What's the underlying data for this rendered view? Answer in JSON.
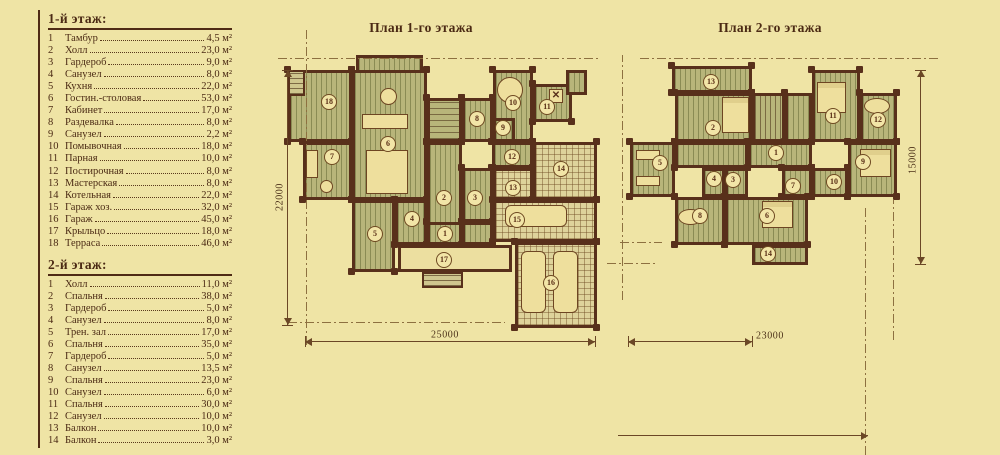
{
  "legend": {
    "sections": [
      {
        "title": "1-й этаж:",
        "rows": [
          [
            "1",
            "Тамбур",
            "4,5 м²"
          ],
          [
            "2",
            "Холл",
            "23,0 м²"
          ],
          [
            "3",
            "Гардероб",
            "9,0 м²"
          ],
          [
            "4",
            "Санузел",
            "8,0 м²"
          ],
          [
            "5",
            "Кухня",
            "22,0 м²"
          ],
          [
            "6",
            "Гостин.-столовая",
            "53,0 м²"
          ],
          [
            "7",
            "Кабинет",
            "17,0 м²"
          ],
          [
            "8",
            "Раздевалка",
            "8,0 м²"
          ],
          [
            "9",
            "Санузел",
            "2,2 м²"
          ],
          [
            "10",
            "Помывочная",
            "18,0 м²"
          ],
          [
            "11",
            "Парная",
            "10,0 м²"
          ],
          [
            "12",
            "Постирочная",
            "8,0 м²"
          ],
          [
            "13",
            "Мастерская",
            "8,0 м²"
          ],
          [
            "14",
            "Котельная",
            "22,0 м²"
          ],
          [
            "15",
            "Гараж хоз.",
            "32,0 м²"
          ],
          [
            "16",
            "Гараж",
            "45,0 м²"
          ],
          [
            "17",
            "Крыльцо",
            "18,0 м²"
          ],
          [
            "18",
            "Терраса",
            "46,0 м²"
          ]
        ]
      },
      {
        "title": "2-й этаж:",
        "rows": [
          [
            "1",
            "Холл",
            "11,0 м²"
          ],
          [
            "2",
            "Спальня",
            "38,0 м²"
          ],
          [
            "3",
            "Гардероб",
            "5,0 м²"
          ],
          [
            "4",
            "Санузел",
            "8,0 м²"
          ],
          [
            "5",
            "Трен. зал",
            "17,0 м²"
          ],
          [
            "6",
            "Спальня",
            "35,0 м²"
          ],
          [
            "7",
            "Гардероб",
            "5,0 м²"
          ],
          [
            "8",
            "Санузел",
            "13,5 м²"
          ],
          [
            "9",
            "Спальня",
            "23,0 м²"
          ],
          [
            "10",
            "Санузел",
            "6,0 м²"
          ],
          [
            "11",
            "Спальня",
            "30,0 м²"
          ],
          [
            "12",
            "Санузел",
            "10,0 м²"
          ],
          [
            "13",
            "Балкон",
            "10,0 м²"
          ],
          [
            "14",
            "Балкон",
            "3,0 м²"
          ]
        ]
      }
    ]
  },
  "plans": [
    {
      "title": "План 1-го этажа",
      "title_left": 321,
      "rooms": [
        {
          "x": 288,
          "y": 70,
          "w": 64,
          "h": 72,
          "f": "plank",
          "n": "18",
          "lx": 329,
          "ly": 102
        },
        {
          "x": 288,
          "y": 70,
          "w": 17,
          "h": 26,
          "f": "steps"
        },
        {
          "x": 303,
          "y": 142,
          "w": 49,
          "h": 58,
          "f": "plank",
          "n": "7",
          "lx": 332,
          "ly": 157
        },
        {
          "x": 356,
          "y": 55,
          "w": 67,
          "h": 18,
          "f": "plank"
        },
        {
          "x": 352,
          "y": 70,
          "w": 75,
          "h": 130,
          "f": "plank",
          "n": "6",
          "lx": 388,
          "ly": 144
        },
        {
          "x": 427,
          "y": 98,
          "w": 35,
          "h": 44,
          "f": "stairs-h"
        },
        {
          "x": 462,
          "y": 98,
          "w": 31,
          "h": 44,
          "f": "plank",
          "n": "8",
          "lx": 477,
          "ly": 119
        },
        {
          "x": 493,
          "y": 70,
          "w": 40,
          "h": 72,
          "f": "plank",
          "n": "10",
          "lx": 513,
          "ly": 103
        },
        {
          "x": 493,
          "y": 118,
          "w": 22,
          "h": 24,
          "f": "plank",
          "n": "9",
          "lx": 503,
          "ly": 128
        },
        {
          "x": 533,
          "y": 84,
          "w": 39,
          "h": 38,
          "f": "plank",
          "n": "11",
          "lx": 547,
          "ly": 107
        },
        {
          "x": 566,
          "y": 70,
          "w": 21,
          "h": 25,
          "f": "plank"
        },
        {
          "x": 492,
          "y": 142,
          "w": 41,
          "h": 26,
          "f": "plank",
          "n": "12",
          "lx": 512,
          "ly": 157
        },
        {
          "x": 533,
          "y": 142,
          "w": 64,
          "h": 58,
          "f": "grid",
          "n": "14",
          "lx": 561,
          "ly": 169
        },
        {
          "x": 493,
          "y": 168,
          "w": 40,
          "h": 32,
          "f": "grid",
          "n": "13",
          "lx": 513,
          "ly": 188
        },
        {
          "x": 427,
          "y": 142,
          "w": 35,
          "h": 103,
          "f": "plank",
          "n": "2",
          "lx": 444,
          "ly": 198
        },
        {
          "x": 462,
          "y": 168,
          "w": 31,
          "h": 54,
          "f": "plank",
          "n": "3",
          "lx": 475,
          "ly": 198
        },
        {
          "x": 462,
          "y": 222,
          "w": 31,
          "h": 23,
          "f": "plank"
        },
        {
          "x": 352,
          "y": 200,
          "w": 43,
          "h": 72,
          "f": "plank",
          "n": "5",
          "lx": 375,
          "ly": 234
        },
        {
          "x": 395,
          "y": 200,
          "w": 32,
          "h": 45,
          "f": "plank",
          "n": "4",
          "lx": 412,
          "ly": 219
        },
        {
          "x": 427,
          "y": 222,
          "w": 35,
          "h": 23,
          "f": "plank",
          "n": "1",
          "lx": 445,
          "ly": 234
        },
        {
          "x": 398,
          "y": 245,
          "w": 114,
          "h": 27,
          "f": "plain",
          "n": "17",
          "lx": 444,
          "ly": 260
        },
        {
          "x": 422,
          "y": 272,
          "w": 41,
          "h": 16,
          "f": "steps"
        },
        {
          "x": 493,
          "y": 200,
          "w": 104,
          "h": 42,
          "f": "grid",
          "n": "15",
          "lx": 517,
          "ly": 220
        },
        {
          "x": 515,
          "y": 242,
          "w": 82,
          "h": 86,
          "f": "grid",
          "n": "16",
          "lx": 551,
          "ly": 283
        }
      ],
      "furniture": [
        {
          "x": 380,
          "y": 88,
          "w": 17,
          "h": 17,
          "s": "circle"
        },
        {
          "x": 362,
          "y": 114,
          "w": 46,
          "h": 15,
          "s": "rect"
        },
        {
          "x": 366,
          "y": 150,
          "w": 42,
          "h": 44,
          "s": "rect"
        },
        {
          "x": 306,
          "y": 150,
          "w": 12,
          "h": 28,
          "s": "rect"
        },
        {
          "x": 320,
          "y": 180,
          "w": 13,
          "h": 13,
          "s": "circle"
        },
        {
          "x": 497,
          "y": 77,
          "w": 26,
          "h": 26,
          "s": "circle"
        },
        {
          "x": 549,
          "y": 89,
          "w": 14,
          "h": 14,
          "s": "x"
        },
        {
          "x": 505,
          "y": 205,
          "w": 62,
          "h": 22,
          "s": "car"
        },
        {
          "x": 521,
          "y": 251,
          "w": 25,
          "h": 62,
          "s": "car"
        },
        {
          "x": 553,
          "y": 251,
          "w": 25,
          "h": 62,
          "s": "car"
        }
      ]
    },
    {
      "title": "План 2-го этажа",
      "title_left": 670,
      "rooms": [
        {
          "x": 672,
          "y": 66,
          "w": 80,
          "h": 27,
          "f": "plank",
          "n": "13",
          "lx": 711,
          "ly": 82
        },
        {
          "x": 675,
          "y": 93,
          "w": 77,
          "h": 49,
          "f": "plank",
          "n": "2",
          "lx": 713,
          "ly": 128
        },
        {
          "x": 752,
          "y": 93,
          "w": 33,
          "h": 49,
          "f": "stairs-v"
        },
        {
          "x": 785,
          "y": 93,
          "w": 27,
          "h": 49,
          "f": "plank"
        },
        {
          "x": 812,
          "y": 70,
          "w": 48,
          "h": 72,
          "f": "plank",
          "n": "11",
          "lx": 833,
          "ly": 116
        },
        {
          "x": 860,
          "y": 93,
          "w": 37,
          "h": 49,
          "f": "plank",
          "n": "12",
          "lx": 878,
          "ly": 120
        },
        {
          "x": 748,
          "y": 142,
          "w": 64,
          "h": 26,
          "f": "plank",
          "n": "1",
          "lx": 776,
          "ly": 153
        },
        {
          "x": 848,
          "y": 142,
          "w": 49,
          "h": 55,
          "f": "plank",
          "n": "9",
          "lx": 863,
          "ly": 162
        },
        {
          "x": 812,
          "y": 168,
          "w": 36,
          "h": 29,
          "f": "plank",
          "n": "10",
          "lx": 834,
          "ly": 182
        },
        {
          "x": 782,
          "y": 168,
          "w": 30,
          "h": 29,
          "f": "plank",
          "n": "7",
          "lx": 793,
          "ly": 186
        },
        {
          "x": 630,
          "y": 142,
          "w": 45,
          "h": 55,
          "f": "plank",
          "n": "5",
          "lx": 660,
          "ly": 163
        },
        {
          "x": 675,
          "y": 142,
          "w": 73,
          "h": 26,
          "f": "plank"
        },
        {
          "x": 702,
          "y": 168,
          "w": 23,
          "h": 29,
          "f": "plank",
          "n": "4",
          "lx": 714,
          "ly": 179
        },
        {
          "x": 725,
          "y": 168,
          "w": 23,
          "h": 29,
          "f": "plank",
          "n": "3",
          "lx": 733,
          "ly": 180
        },
        {
          "x": 675,
          "y": 197,
          "w": 50,
          "h": 48,
          "f": "plank",
          "n": "8",
          "lx": 700,
          "ly": 216
        },
        {
          "x": 725,
          "y": 197,
          "w": 83,
          "h": 48,
          "f": "plank",
          "n": "6",
          "lx": 767,
          "ly": 216
        },
        {
          "x": 752,
          "y": 245,
          "w": 56,
          "h": 20,
          "f": "plank",
          "n": "14",
          "lx": 768,
          "ly": 254
        }
      ],
      "furniture": [
        {
          "x": 722,
          "y": 97,
          "w": 27,
          "h": 36,
          "s": "bed"
        },
        {
          "x": 817,
          "y": 82,
          "w": 29,
          "h": 31,
          "s": "bed"
        },
        {
          "x": 860,
          "y": 149,
          "w": 31,
          "h": 28,
          "s": "bed"
        },
        {
          "x": 762,
          "y": 201,
          "w": 31,
          "h": 27,
          "s": "bed"
        },
        {
          "x": 864,
          "y": 98,
          "w": 26,
          "h": 16,
          "s": "circle"
        },
        {
          "x": 678,
          "y": 209,
          "w": 25,
          "h": 16,
          "s": "circle"
        },
        {
          "x": 636,
          "y": 150,
          "w": 24,
          "h": 10,
          "s": "rect"
        },
        {
          "x": 636,
          "y": 176,
          "w": 24,
          "h": 10,
          "s": "rect"
        }
      ]
    }
  ],
  "dimensions": [
    {
      "o": "v",
      "x": 287,
      "y1": 70,
      "y2": 325,
      "t": "22000",
      "lx": 280,
      "ly": 197
    },
    {
      "o": "h",
      "y": 341,
      "x1": 305,
      "x2": 595,
      "t": "25000",
      "lx": 445,
      "ly": 335
    },
    {
      "o": "h",
      "y": 341,
      "x1": 628,
      "x2": 752,
      "t": "23000",
      "lx": 770,
      "ly": 336
    },
    {
      "o": "v",
      "x": 920,
      "y1": 70,
      "y2": 264,
      "t": "15000",
      "lx": 913,
      "ly": 160
    },
    {
      "o": "h-arrow",
      "y": 435,
      "x1": 618,
      "x2": 868,
      "t": ""
    }
  ],
  "axes": [
    {
      "o": "h",
      "y": 58,
      "x1": 278,
      "x2": 600
    },
    {
      "o": "h",
      "y": 58,
      "x1": 640,
      "x2": 940
    },
    {
      "o": "v",
      "x": 306,
      "y1": 28,
      "y2": 345
    },
    {
      "o": "v",
      "x": 622,
      "y1": 55,
      "y2": 300
    },
    {
      "o": "h",
      "y": 322,
      "x1": 288,
      "x2": 505
    },
    {
      "o": "v",
      "x": 865,
      "y1": 205,
      "y2": 455
    },
    {
      "o": "v",
      "x": 893,
      "y1": 200,
      "y2": 340
    },
    {
      "o": "h",
      "y": 242,
      "x1": 620,
      "x2": 662
    },
    {
      "o": "h",
      "y": 263,
      "x1": 607,
      "x2": 658
    }
  ]
}
